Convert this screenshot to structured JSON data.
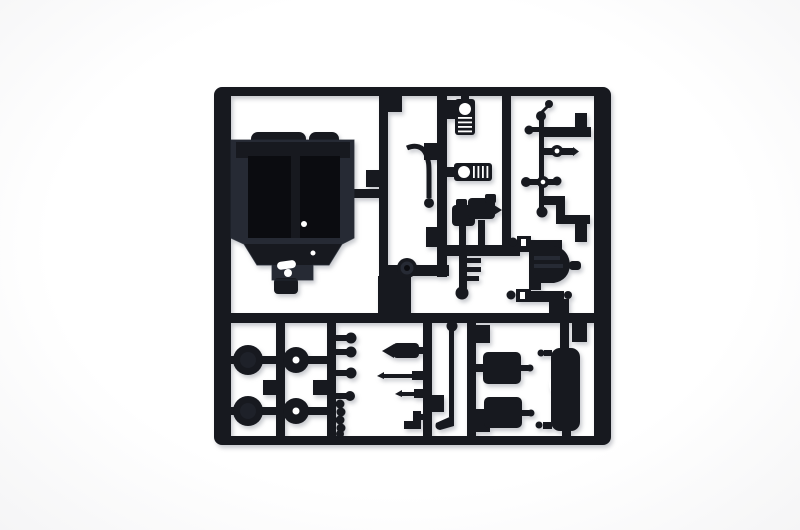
{
  "image": {
    "kind": "product-photo",
    "subject": "black injection-molded model kit sprue (parts tree) photographed on a white background",
    "text_content": "none"
  },
  "colors": {
    "paper": "#ffffff",
    "plastic": "#17191f",
    "plastic_light": "#262a34",
    "plastic_dark": "#0b0c10",
    "shadow": "rgba(95,100,115,0.35)"
  },
  "parts": {
    "frame": "rectangular runner frame with mid rail and divider bars",
    "cab_shell": "large cab body shell with twin roof bumps and tapered lower edge",
    "canister_vertical": "ribbed canister part with round boss, hung from top rail",
    "canister_horizontal": "ribbed canister part with round boss, attached to inner runner",
    "curved_hose": "curved rod ending in a ball",
    "carburetor_blocks": "two small irregular blocks on stems",
    "peg_comb": "stem with three side pegs and a ball tip",
    "grommet": "round grommet molded on lower runner",
    "runner_block": "thick rectangular runner block above mid rail",
    "linkage_rod": "thin vertical rod with ball joints and side balls",
    "tie_rod_ring": "horizontal rod with molded ring and pointed tip",
    "diff_housing": "bell-shaped axle housing with shaft stub",
    "slotted_pegs": "two slotted pegs with ball gates",
    "wheels_solid": "two large solid wheel discs",
    "wheels_hub": "two hub discs with center holes",
    "ball_pegs": "four stub-and-ball gates on divider",
    "ball_chain": "vertical chain of small balls",
    "muffler": "bullet-nosed muffler body",
    "needle_rods": "two tapered needle rods",
    "corner_bracket": "small boot-shaped bracket",
    "exhaust_pipe": "long pipe with ball top and flared foot",
    "seat_cushions": "two rounded rectangular cushions",
    "door_panel": "tall rounded door panel"
  }
}
